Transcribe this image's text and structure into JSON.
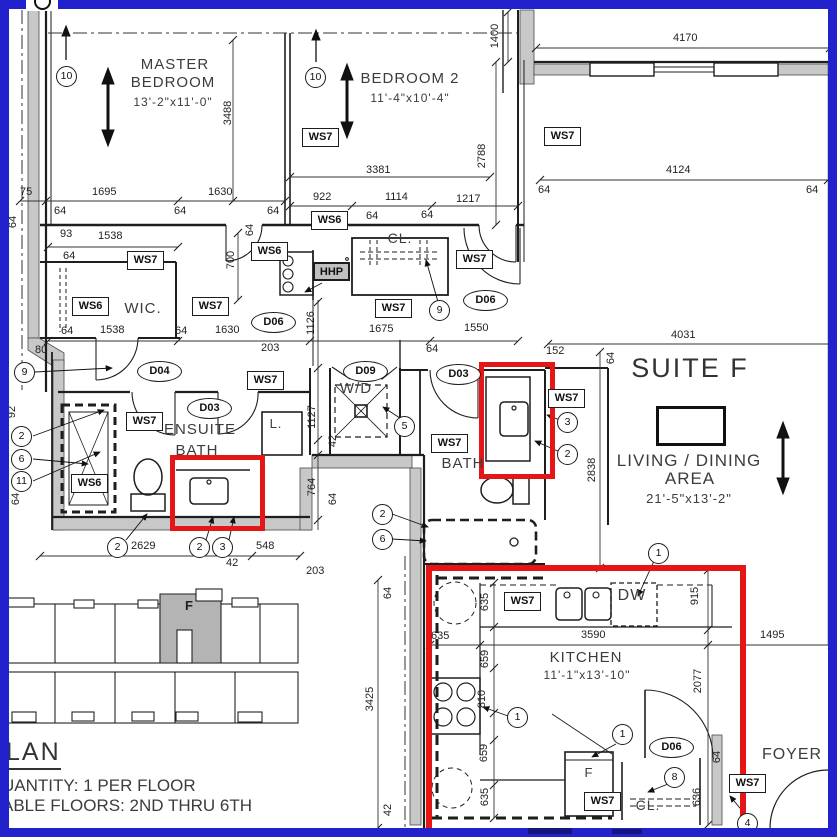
{
  "colors": {
    "border": "#2222cc",
    "highlight": "#e41616",
    "wall_gray": "#c8c8c8"
  },
  "rooms": {
    "master": {
      "line1": "MASTER",
      "line2": "BEDROOM",
      "size": "13'-2\"x11'-0\""
    },
    "bedroom2": {
      "name": "BEDROOM 2",
      "size": "11'-4\"x10'-4\""
    },
    "suite": {
      "name": "SUITE F"
    },
    "living": {
      "line1": "LIVING / DINING",
      "line2": "AREA",
      "size": "21'-5\"x13'-2\""
    },
    "kitchen": {
      "name": "KITCHEN",
      "size": "11'-1\"x13'-10\""
    },
    "ensuite": {
      "line1": "ENSUITE",
      "line2": "BATH"
    },
    "bath": "BATH",
    "wic": "WIC.",
    "closet_hall": "CL.",
    "closet_kitchen": "CL.",
    "linen": "L.",
    "laundry": "W/D",
    "dishwasher": "DW",
    "fridge": "F",
    "foyer": "FOYER",
    "keyplan_unit": "F"
  },
  "notes": {
    "plan_title": "LAN",
    "quantity": "UANTITY: 1 PER FLOOR",
    "floors": "ABLE FLOORS: 2ND THRU 6TH"
  },
  "wall_tags": [
    "WS7",
    "WS7",
    "WS7",
    "WS6",
    "WS6",
    "WS6",
    "WS7",
    "HHP",
    "WS7",
    "WS7",
    "WS7",
    "WS6",
    "WS7",
    "WS7",
    "WS7",
    "WS7",
    "WS7",
    "WS7"
  ],
  "door_tags": [
    "D06",
    "D04",
    "D03",
    "D09",
    "D03",
    "D06",
    "D06"
  ],
  "keynotes": [
    "10",
    "10",
    "9",
    "9",
    "2",
    "6",
    "11",
    "2",
    "2",
    "3",
    "5",
    "2",
    "6",
    "3",
    "2",
    "1",
    "1",
    "1",
    "8",
    "4"
  ],
  "dims_h": [
    "75",
    "1695",
    "1630",
    "64",
    "64",
    "64",
    "922",
    "3381",
    "1114",
    "1217",
    "64",
    "64",
    "4170",
    "4124",
    "64",
    "64",
    "93",
    "1538",
    "64",
    "1538",
    "64",
    "64",
    "1630",
    "80",
    "203",
    "1675",
    "1550",
    "64",
    "152",
    "4031",
    "2629",
    "42",
    "548",
    "203",
    "635",
    "3590",
    "1495"
  ],
  "dims_v": [
    "3488",
    "1400",
    "2788",
    "64",
    "700",
    "64",
    "92",
    "64",
    "1126",
    "1127",
    "42",
    "764",
    "64",
    "2838",
    "64",
    "915",
    "2077",
    "635",
    "659",
    "810",
    "659",
    "635",
    "3425",
    "64",
    "42",
    "636",
    "64"
  ]
}
